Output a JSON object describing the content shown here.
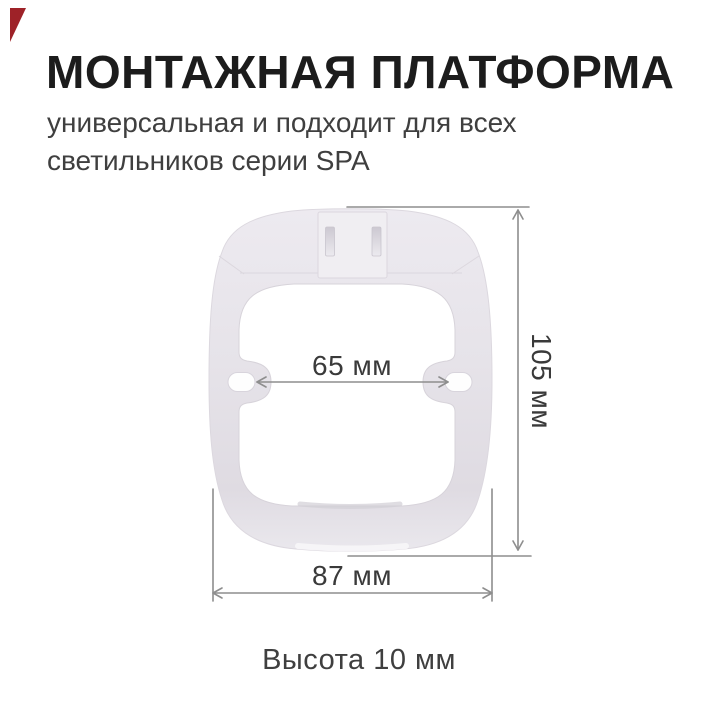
{
  "header": {
    "title": "МОНТАЖНАЯ ПЛАТФОРМА",
    "subtitle": "универсальная и подходит для всех светильников серии SPA"
  },
  "diagram": {
    "dim_inner_width": "65 мм",
    "dim_height": "105 мм",
    "dim_outer_width": "87 мм",
    "footer_note": "Высота 10 мм"
  },
  "colors": {
    "accent_red": "#9E2228",
    "text_primary": "#1C1C1C",
    "text_secondary": "#3F3F3F",
    "dim_line": "#8E8E8E",
    "dim_text": "#3A3A3A",
    "body_fill": "#E7E4EA"
  }
}
